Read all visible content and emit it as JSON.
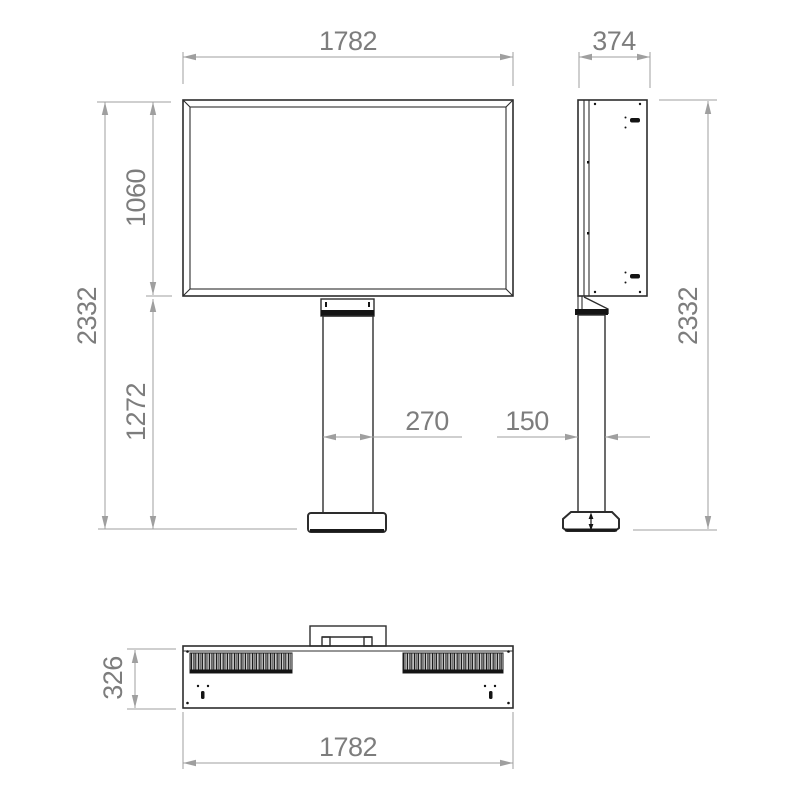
{
  "drawing": {
    "kind": "orthographic technical drawing",
    "subject": "pole-mounted outdoor digital signage totem",
    "background": "#ffffff",
    "line_color": "#2d2d2d",
    "dimension_line_color": "#9f9f9f",
    "dimension_text_color": "#7d7d7d"
  },
  "dimensions": {
    "front_width": "1782",
    "side_depth": "374",
    "screen_height": "1060",
    "total_height_left": "2332",
    "pole_height": "1272",
    "pole_width": "270",
    "pole_depth": "150",
    "total_height_right": "2332",
    "top_view_depth": "326",
    "top_view_width": "1782"
  }
}
